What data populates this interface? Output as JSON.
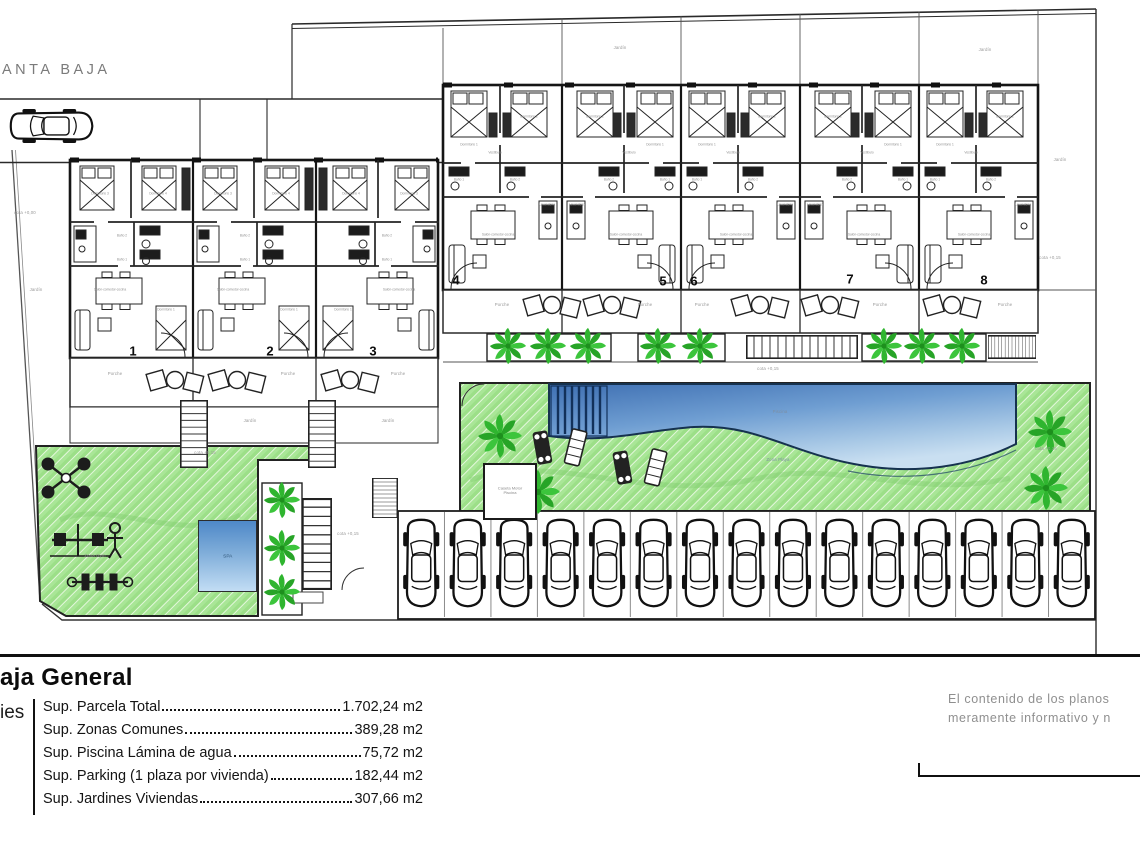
{
  "header": {
    "plan_label": "ANTA BAJA"
  },
  "plan": {
    "unit_numbers_left": [
      "1",
      "2",
      "3"
    ],
    "unit_numbers_right": [
      "4",
      "5",
      "6",
      "7",
      "8"
    ],
    "parking_spaces": 15,
    "labels": {
      "porch": "Porche",
      "garden": "Jardín",
      "cota_zero": "cota +0,00",
      "cota_15": "cota +0,15",
      "spa": "SPA",
      "caseta": "Caseta Motor Piscina",
      "zona_gym": "Zona Gym",
      "zona_playa": "Zona Playa",
      "piscina": "Piscina"
    },
    "rooms_left": [
      "Dormitorio 3",
      "Dormitorio 4",
      "Baño 2",
      "Baño 1",
      "Dormitorio 1",
      "Salón-comedor-cocina"
    ],
    "rooms_right": [
      "Dormitorio 1",
      "Dormitorio 2",
      "Vestíbulo",
      "Baño 1",
      "Baño 2",
      "Lavandería",
      "Salón-comedor-cocina"
    ]
  },
  "legend": {
    "title": "aja General",
    "side_label": "ies",
    "items": [
      {
        "label": "Sup. Parcela Total",
        "value": "1.702,24 m2"
      },
      {
        "label": "Sup. Zonas Comunes",
        "value": "389,28 m2"
      },
      {
        "label": "Sup. Piscina Lámina de agua",
        "value": "75,72 m2"
      },
      {
        "label": "Sup. Parking (1 plaza por vivienda)",
        "value": "182,44 m2"
      },
      {
        "label": "Sup. Jardines Viviendas",
        "value": "307,66 m2"
      }
    ],
    "disclaimer1": "El contenido de los planos",
    "disclaimer2": "meramente informativo y n"
  },
  "colors": {
    "lawn_green": "#9cdf88",
    "palm_green": "#2fb52f",
    "pool_dark": "#3e6fb2",
    "pool_light": "#c9dff1",
    "line": "#1a1a1a"
  }
}
